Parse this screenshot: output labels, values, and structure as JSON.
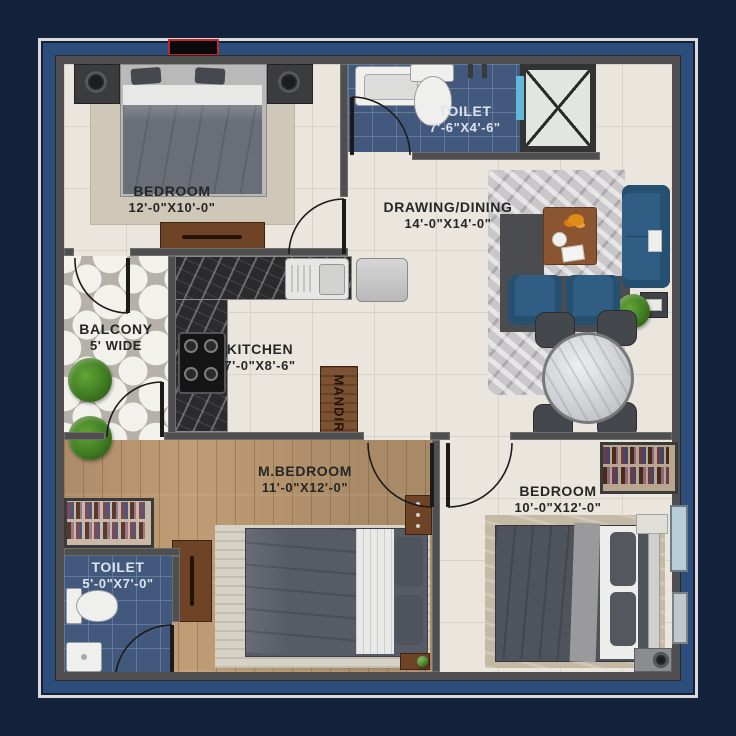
{
  "plan": {
    "rooms": {
      "bedroom_top": {
        "name": "BEDROOM",
        "dims": "12'-0\"X10'-0\""
      },
      "toilet_top": {
        "name": "TOILET",
        "dims": "7'-6\"X4'-6\""
      },
      "drawing_dining": {
        "name": "DRAWING/DINING",
        "dims": "14'-0\"X14'-0\""
      },
      "balcony": {
        "name": "BALCONY",
        "dims": "5' WIDE"
      },
      "kitchen": {
        "name": "KITCHEN",
        "dims": "7'-0\"X8'-6\""
      },
      "mandir": {
        "name": "MANDIR"
      },
      "master_bedroom": {
        "name": "M.BEDROOM",
        "dims": "11'-0\"X12'-0\""
      },
      "bedroom_right": {
        "name": "BEDROOM",
        "dims": "10'-0\"X12'-0\""
      },
      "toilet_bottom": {
        "name": "TOILET",
        "dims": "5'-0\"X7'-0\""
      }
    },
    "palette": {
      "background_navy": "#13223a",
      "frame_blue": "#2d4d7c",
      "frame_line": "#d9d9d9",
      "wall_gray": "#4f4f4f",
      "floor_tile_cream": "#eae6de",
      "toilet_tile_blue": "#42597d",
      "wood_floor": "#c09d75",
      "sofa_blue": "#2f5d84",
      "furniture_brown": "#6e4326",
      "counter_marble": "#2b2b2e",
      "accent_red": "#c0272d"
    }
  }
}
